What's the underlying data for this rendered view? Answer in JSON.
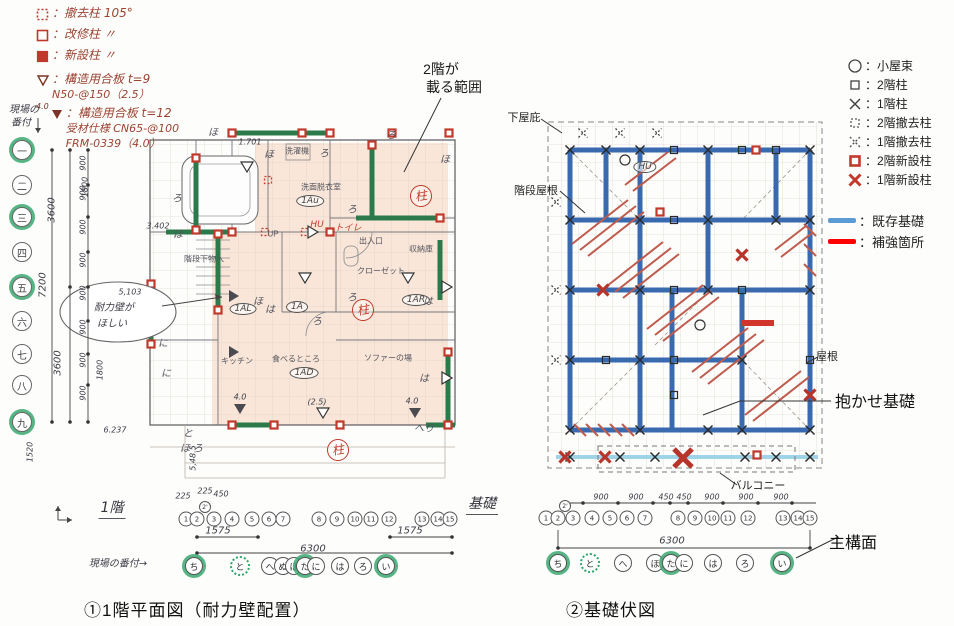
{
  "titles": {
    "left": "①1階平面図（耐力壁配置）",
    "right": "②基礎伏図"
  },
  "palette": {
    "wall_green": "#2c7a4b",
    "accent_red": "#c0392b",
    "foundation_blue": "#2f63ad",
    "existing_blue": "#5b9bd5",
    "reinforce_red": "#ff0000",
    "shade_peach": "#f8e0cf",
    "highlight_green": "#3aa870"
  },
  "hand_legend": {
    "items": [
      {
        "icon": "dotted-red-square",
        "label": "：撤去柱 105°"
      },
      {
        "icon": "open-red-square",
        "label": "：改修柱 〃"
      },
      {
        "icon": "filled-red-square",
        "label": "：新設柱 〃"
      },
      {
        "icon": "open-triangle",
        "label": "：構造用合板 t=9",
        "sub": "N50-@150（2.5）"
      },
      {
        "icon": "filled-triangle",
        "note": "4.0",
        "label": "：構造用合板 t=12",
        "sub": "受材仕様 CN65-@100",
        "sub2": "FRM-0339（4.0）"
      }
    ]
  },
  "typed_legend": {
    "items": [
      {
        "icon": "circle",
        "label": "：小屋束"
      },
      {
        "icon": "square",
        "label": "：2階柱"
      },
      {
        "icon": "x",
        "label": "：1階柱"
      },
      {
        "icon": "dashed-square",
        "label": "：2階撤去柱"
      },
      {
        "icon": "dashed-x",
        "label": "：1階撤去柱"
      },
      {
        "icon": "red-square",
        "label": "：2階新設柱"
      },
      {
        "icon": "red-x",
        "label": "：1階新設柱"
      }
    ],
    "foundation_items": [
      {
        "icon": "blue-bar",
        "label": "：既存基礎"
      },
      {
        "icon": "red-bar",
        "label": "：補強箇所"
      }
    ]
  },
  "floor_plan": {
    "marks": [
      {
        "t": "現場の",
        "x": 24,
        "y": 108,
        "cls": "hw tiny",
        "n": "site-banzuke-note"
      },
      {
        "t": "番付",
        "x": 21,
        "y": 121,
        "cls": "hw tiny",
        "n": "site-banzuke-note"
      },
      {
        "t": "一",
        "x": 22,
        "y": 150,
        "cls": "kc hl",
        "n": "row-axis-1"
      },
      {
        "t": "二",
        "x": 22,
        "y": 185,
        "cls": "kc",
        "n": "row-axis-2"
      },
      {
        "t": "三",
        "x": 22,
        "y": 217,
        "cls": "kc hl",
        "n": "row-axis-3"
      },
      {
        "t": "四",
        "x": 22,
        "y": 252,
        "cls": "kc",
        "n": "row-axis-4"
      },
      {
        "t": "五",
        "x": 22,
        "y": 287,
        "cls": "kc hl",
        "n": "row-axis-5"
      },
      {
        "t": "六",
        "x": 22,
        "y": 321,
        "cls": "kc",
        "n": "row-axis-6"
      },
      {
        "t": "七",
        "x": 22,
        "y": 354,
        "cls": "kc",
        "n": "row-axis-7"
      },
      {
        "t": "八",
        "x": 22,
        "y": 385,
        "cls": "kc",
        "n": "row-axis-8"
      },
      {
        "t": "九",
        "x": 22,
        "y": 422,
        "cls": "kc hl",
        "n": "row-axis-9"
      },
      {
        "t": "1",
        "x": 186,
        "y": 519,
        "cls": "nc"
      },
      {
        "t": "2",
        "x": 197,
        "y": 519,
        "cls": "nc"
      },
      {
        "t": "2'",
        "x": 205,
        "y": 507,
        "cls": "nc np"
      },
      {
        "t": "3",
        "x": 214,
        "y": 519,
        "cls": "nc"
      },
      {
        "t": "4",
        "x": 232,
        "y": 519,
        "cls": "nc"
      },
      {
        "t": "5",
        "x": 252,
        "y": 519,
        "cls": "nc"
      },
      {
        "t": "6",
        "x": 269,
        "y": 519,
        "cls": "nc"
      },
      {
        "t": "7",
        "x": 283,
        "y": 519,
        "cls": "nc"
      },
      {
        "t": "8",
        "x": 319,
        "y": 519,
        "cls": "nc"
      },
      {
        "t": "9",
        "x": 337,
        "y": 519,
        "cls": "nc"
      },
      {
        "t": "10",
        "x": 355,
        "y": 519,
        "cls": "nc"
      },
      {
        "t": "11",
        "x": 371,
        "y": 519,
        "cls": "nc"
      },
      {
        "t": "12",
        "x": 389,
        "y": 519,
        "cls": "nc"
      },
      {
        "t": "13",
        "x": 422,
        "y": 519,
        "cls": "nc"
      },
      {
        "t": "14",
        "x": 438,
        "y": 519,
        "cls": "nc"
      },
      {
        "t": "15",
        "x": 450,
        "y": 519,
        "cls": "nc"
      },
      {
        "t": "ち",
        "x": 194,
        "y": 566,
        "cls": "hc hl"
      },
      {
        "t": "と",
        "x": 240,
        "y": 566,
        "cls": "hc hld"
      },
      {
        "t": "へ",
        "x": 270,
        "y": 566,
        "cls": "hc"
      },
      {
        "t": "ぬ",
        "x": 283,
        "y": 566,
        "cls": "hc"
      },
      {
        "t": "ほ",
        "x": 294,
        "y": 566,
        "cls": "hc"
      },
      {
        "t": "た",
        "x": 305,
        "y": 566,
        "cls": "hc hl"
      },
      {
        "t": "に",
        "x": 316,
        "y": 566,
        "cls": "hc"
      },
      {
        "t": "は",
        "x": 340,
        "y": 566,
        "cls": "hc"
      },
      {
        "t": "ろ",
        "x": 363,
        "y": 566,
        "cls": "hc"
      },
      {
        "t": "い",
        "x": 386,
        "y": 566,
        "cls": "hc hl"
      },
      {
        "t": "現場の番付→",
        "x": 118,
        "y": 562,
        "cls": "hw"
      },
      {
        "t": "1階",
        "x": 112,
        "y": 508,
        "cls": "cap",
        "n": "floor-plan-caption"
      },
      {
        "t": "1.701",
        "x": 250,
        "y": 142,
        "cls": "hd tiny"
      },
      {
        "t": "1800",
        "x": 85,
        "y": 187,
        "cls": "hd rot tiny"
      },
      {
        "t": "1800",
        "x": 100,
        "y": 370,
        "cls": "hd rot tiny"
      },
      {
        "t": "3.402",
        "x": 158,
        "y": 226,
        "cls": "hd tiny"
      },
      {
        "t": "3600",
        "x": 52,
        "y": 210,
        "cls": "hd rot"
      },
      {
        "t": "3600",
        "x": 58,
        "y": 363,
        "cls": "hd rot"
      },
      {
        "t": "7200",
        "x": 43,
        "y": 285,
        "cls": "hd rot"
      },
      {
        "t": "1520",
        "x": 30,
        "y": 452,
        "cls": "hd rot tiny"
      },
      {
        "t": "900",
        "x": 83,
        "y": 163,
        "cls": "hd rot tiny"
      },
      {
        "t": "900",
        "x": 83,
        "y": 193,
        "cls": "hd rot tiny"
      },
      {
        "t": "900",
        "x": 83,
        "y": 227,
        "cls": "hd rot tiny"
      },
      {
        "t": "900",
        "x": 83,
        "y": 260,
        "cls": "hd rot tiny"
      },
      {
        "t": "900",
        "x": 83,
        "y": 293,
        "cls": "hd rot tiny"
      },
      {
        "t": "900",
        "x": 83,
        "y": 327,
        "cls": "hd rot tiny"
      },
      {
        "t": "900",
        "x": 83,
        "y": 360,
        "cls": "hd rot tiny"
      },
      {
        "t": "900",
        "x": 83,
        "y": 393,
        "cls": "hd rot tiny"
      },
      {
        "t": "6.237",
        "x": 115,
        "y": 430,
        "cls": "hd tiny"
      },
      {
        "t": "5,48.5",
        "x": 193,
        "y": 458,
        "cls": "hd rot tiny"
      },
      {
        "t": "225",
        "x": 183,
        "y": 496,
        "cls": "hd tiny"
      },
      {
        "t": "225",
        "x": 205,
        "y": 491,
        "cls": "hd tiny"
      },
      {
        "t": "450",
        "x": 221,
        "y": 494,
        "cls": "hd tiny"
      },
      {
        "t": "1575",
        "x": 218,
        "y": 531,
        "cls": "hd"
      },
      {
        "t": "6300",
        "x": 313,
        "y": 549,
        "cls": "hd"
      },
      {
        "t": "1575",
        "x": 410,
        "y": 531,
        "cls": "hd"
      },
      {
        "t": "5,103",
        "x": 130,
        "y": 292,
        "cls": "hd tiny"
      },
      {
        "t": "耐力壁が",
        "x": 114,
        "y": 306,
        "cls": "hw",
        "n": "cloud-note"
      },
      {
        "t": "ほしい",
        "x": 112,
        "y": 322,
        "cls": "hw",
        "n": "cloud-note"
      },
      {
        "t": "(2.5)",
        "x": 317,
        "y": 402,
        "cls": "hd tiny"
      },
      {
        "t": "4.0",
        "x": 412,
        "y": 401,
        "cls": "hd tiny"
      },
      {
        "t": "4.0",
        "x": 240,
        "y": 397,
        "cls": "hd tiny"
      },
      {
        "t": "2階が",
        "x": 441,
        "y": 69,
        "cls": "co",
        "n": "second-floor-area-callout"
      },
      {
        "t": "載る範囲",
        "x": 454,
        "y": 87,
        "cls": "co",
        "n": "second-floor-area-callout"
      },
      {
        "t": "洗濯機",
        "x": 297,
        "y": 151,
        "cls": "rm"
      },
      {
        "t": "洗面脱衣室",
        "x": 321,
        "y": 187,
        "cls": "rm"
      },
      {
        "t": "階段下物入",
        "x": 204,
        "y": 259,
        "cls": "rm"
      },
      {
        "t": "UP",
        "x": 273,
        "y": 234,
        "cls": "rm"
      },
      {
        "t": "出入口",
        "x": 371,
        "y": 241,
        "cls": "rm"
      },
      {
        "t": "収納庫",
        "x": 421,
        "y": 249,
        "cls": "rm"
      },
      {
        "t": "クローゼット",
        "x": 381,
        "y": 271,
        "cls": "rm"
      },
      {
        "t": "キッチン",
        "x": 237,
        "y": 361,
        "cls": "rm"
      },
      {
        "t": "食べるところ",
        "x": 296,
        "y": 359,
        "cls": "rm"
      },
      {
        "t": "ソファーの場",
        "x": 388,
        "y": 358,
        "cls": "rm"
      },
      {
        "t": "1Au",
        "x": 310,
        "y": 201,
        "cls": "et"
      },
      {
        "t": "1AL",
        "x": 243,
        "y": 309,
        "cls": "et"
      },
      {
        "t": "1A",
        "x": 297,
        "y": 307,
        "cls": "et"
      },
      {
        "t": "1AR",
        "x": 416,
        "y": 300,
        "cls": "et"
      },
      {
        "t": "1AD",
        "x": 304,
        "y": 373,
        "cls": "et"
      },
      {
        "t": "トイレ",
        "x": 348,
        "y": 227,
        "cls": "rh",
        "n": "toilet-stamp"
      },
      {
        "t": "HU",
        "x": 317,
        "y": 225,
        "cls": "rh"
      },
      {
        "t": "柱",
        "x": 421,
        "y": 196,
        "cls": "st",
        "n": "pillar-stamp"
      },
      {
        "t": "柱",
        "x": 363,
        "y": 310,
        "cls": "st",
        "n": "pillar-stamp"
      },
      {
        "t": "柱",
        "x": 338,
        "y": 450,
        "cls": "st",
        "n": "pillar-stamp"
      },
      {
        "t": "ほ",
        "x": 213,
        "y": 131,
        "cls": "lt"
      },
      {
        "t": "ほ",
        "x": 269,
        "y": 153,
        "cls": "lt"
      },
      {
        "t": "ろ",
        "x": 324,
        "y": 152,
        "cls": "lt"
      },
      {
        "t": "ろ",
        "x": 391,
        "y": 134,
        "cls": "lt"
      },
      {
        "t": "ほ",
        "x": 445,
        "y": 158,
        "cls": "lt"
      },
      {
        "t": "ろ",
        "x": 177,
        "y": 197,
        "cls": "lt"
      },
      {
        "t": "ほ",
        "x": 178,
        "y": 233,
        "cls": "lt"
      },
      {
        "t": "ろ",
        "x": 352,
        "y": 208,
        "cls": "lt"
      },
      {
        "t": "ろ",
        "x": 352,
        "y": 296,
        "cls": "lt"
      },
      {
        "t": "に",
        "x": 163,
        "y": 342,
        "cls": "lt"
      },
      {
        "t": "に",
        "x": 166,
        "y": 372,
        "cls": "lt"
      },
      {
        "t": "ほ",
        "x": 258,
        "y": 300,
        "cls": "lt"
      },
      {
        "t": "は",
        "x": 270,
        "y": 308,
        "cls": "lt"
      },
      {
        "t": "ろ",
        "x": 317,
        "y": 320,
        "cls": "lt"
      },
      {
        "t": "は",
        "x": 428,
        "y": 300,
        "cls": "lt"
      },
      {
        "t": "は",
        "x": 424,
        "y": 377,
        "cls": "lt"
      },
      {
        "t": "と",
        "x": 188,
        "y": 432,
        "cls": "lt"
      },
      {
        "t": "ほ",
        "x": 185,
        "y": 447,
        "cls": "lt"
      },
      {
        "t": "ろ",
        "x": 198,
        "y": 447,
        "cls": "lt"
      },
      {
        "t": "へり",
        "x": 424,
        "y": 427,
        "cls": "lt"
      }
    ]
  },
  "foundation_plan": {
    "marks": [
      {
        "t": "1",
        "x": 546,
        "y": 518,
        "cls": "nc"
      },
      {
        "t": "2",
        "x": 558,
        "y": 518,
        "cls": "nc"
      },
      {
        "t": "2'",
        "x": 565,
        "y": 506,
        "cls": "nc np"
      },
      {
        "t": "3",
        "x": 573,
        "y": 518,
        "cls": "nc"
      },
      {
        "t": "4",
        "x": 592,
        "y": 518,
        "cls": "nc"
      },
      {
        "t": "5",
        "x": 610,
        "y": 518,
        "cls": "nc"
      },
      {
        "t": "6",
        "x": 627,
        "y": 518,
        "cls": "nc"
      },
      {
        "t": "7",
        "x": 645,
        "y": 518,
        "cls": "nc"
      },
      {
        "t": "8",
        "x": 678,
        "y": 518,
        "cls": "nc"
      },
      {
        "t": "9",
        "x": 695,
        "y": 518,
        "cls": "nc"
      },
      {
        "t": "10",
        "x": 712,
        "y": 518,
        "cls": "nc"
      },
      {
        "t": "11",
        "x": 728,
        "y": 518,
        "cls": "nc"
      },
      {
        "t": "12",
        "x": 748,
        "y": 518,
        "cls": "nc"
      },
      {
        "t": "13",
        "x": 783,
        "y": 518,
        "cls": "nc"
      },
      {
        "t": "14",
        "x": 798,
        "y": 518,
        "cls": "nc"
      },
      {
        "t": "15",
        "x": 810,
        "y": 518,
        "cls": "nc"
      },
      {
        "t": "ち",
        "x": 558,
        "y": 563,
        "cls": "hc hl"
      },
      {
        "t": "と",
        "x": 590,
        "y": 563,
        "cls": "hc hld"
      },
      {
        "t": "へ",
        "x": 623,
        "y": 563,
        "cls": "hc"
      },
      {
        "t": "ほ",
        "x": 655,
        "y": 563,
        "cls": "hc"
      },
      {
        "t": "た",
        "x": 671,
        "y": 563,
        "cls": "hc hl"
      },
      {
        "t": "に",
        "x": 684,
        "y": 563,
        "cls": "hc"
      },
      {
        "t": "は",
        "x": 713,
        "y": 563,
        "cls": "hc"
      },
      {
        "t": "ろ",
        "x": 745,
        "y": 563,
        "cls": "hc"
      },
      {
        "t": "い",
        "x": 782,
        "y": 563,
        "cls": "hc hl"
      },
      {
        "t": "900",
        "x": 601,
        "y": 497,
        "cls": "hd tiny"
      },
      {
        "t": "900",
        "x": 636,
        "y": 497,
        "cls": "hd tiny"
      },
      {
        "t": "450",
        "x": 666,
        "y": 497,
        "cls": "hd tiny"
      },
      {
        "t": "450",
        "x": 684,
        "y": 497,
        "cls": "hd tiny"
      },
      {
        "t": "900",
        "x": 712,
        "y": 497,
        "cls": "hd tiny"
      },
      {
        "t": "900",
        "x": 746,
        "y": 497,
        "cls": "hd tiny"
      },
      {
        "t": "900",
        "x": 781,
        "y": 497,
        "cls": "hd tiny"
      },
      {
        "t": "6300",
        "x": 672,
        "y": 541,
        "cls": "hd"
      },
      {
        "t": "基礎",
        "x": 482,
        "y": 504,
        "cls": "cap",
        "n": "foundation-plan-caption"
      },
      {
        "t": "下屋庇",
        "x": 524,
        "y": 117,
        "cls": "co2",
        "n": "geya-eave-callout"
      },
      {
        "t": "階段屋根",
        "x": 536,
        "y": 190,
        "cls": "co2",
        "n": "stair-roof-callout"
      },
      {
        "t": "屋根",
        "x": 827,
        "y": 356,
        "cls": "co2",
        "n": "roof-callout"
      },
      {
        "t": "バルコニー",
        "x": 758,
        "y": 485,
        "cls": "co2",
        "n": "balcony-callout"
      },
      {
        "t": "抱かせ基礎",
        "x": 875,
        "y": 400,
        "cls": "co3",
        "n": "dakase-foundation-callout"
      },
      {
        "t": "主構面",
        "x": 853,
        "y": 541,
        "cls": "co3",
        "n": "main-frame-callout"
      },
      {
        "t": "HU",
        "x": 645,
        "y": 167,
        "cls": "et"
      }
    ]
  }
}
